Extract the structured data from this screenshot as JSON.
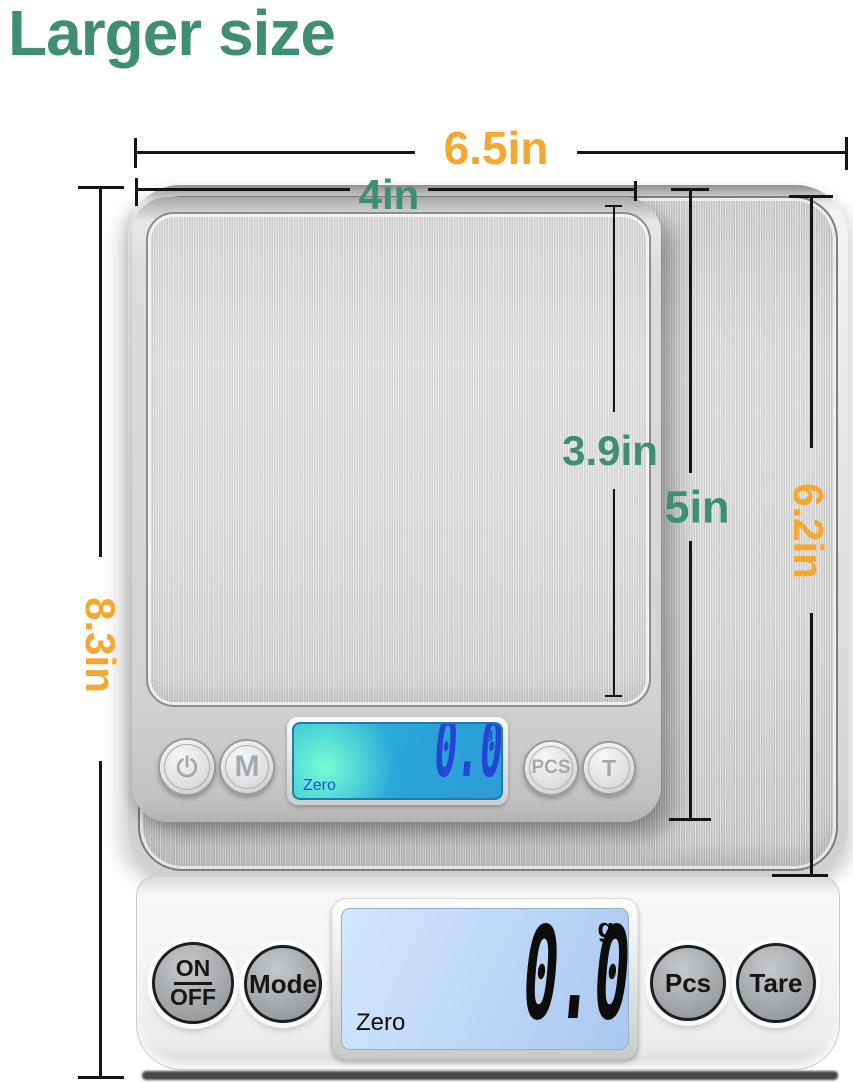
{
  "title": "Larger size",
  "annotations": {
    "large_width": "6.5in",
    "small_width": "4in",
    "large_height": "8.3in",
    "small_platform_height": "3.9in",
    "small_height": "5in",
    "large_platform_height": "6.2in"
  },
  "colors": {
    "title_green": "#3E8E74",
    "accent_orange": "#F6A72E",
    "annotation_line": "#141414",
    "small_lcd_blue": "#2AA4DA",
    "small_lcd_digit_blue": "#2446D6",
    "large_lcd_blue": "#BCD6F6"
  },
  "small_scale": {
    "power_icon": "power",
    "mode_button": "M",
    "pcs_button": "PCS",
    "tare_button": "T",
    "display": {
      "value": "0.0",
      "unit": "g",
      "status": "Zero"
    }
  },
  "large_scale": {
    "onoff_button": {
      "line1": "ON",
      "line2": "OFF"
    },
    "mode_button": "Mode",
    "pcs_button": "Pcs",
    "tare_button": "Tare",
    "display": {
      "value": "0.0",
      "unit": "g",
      "status": "Zero"
    }
  }
}
